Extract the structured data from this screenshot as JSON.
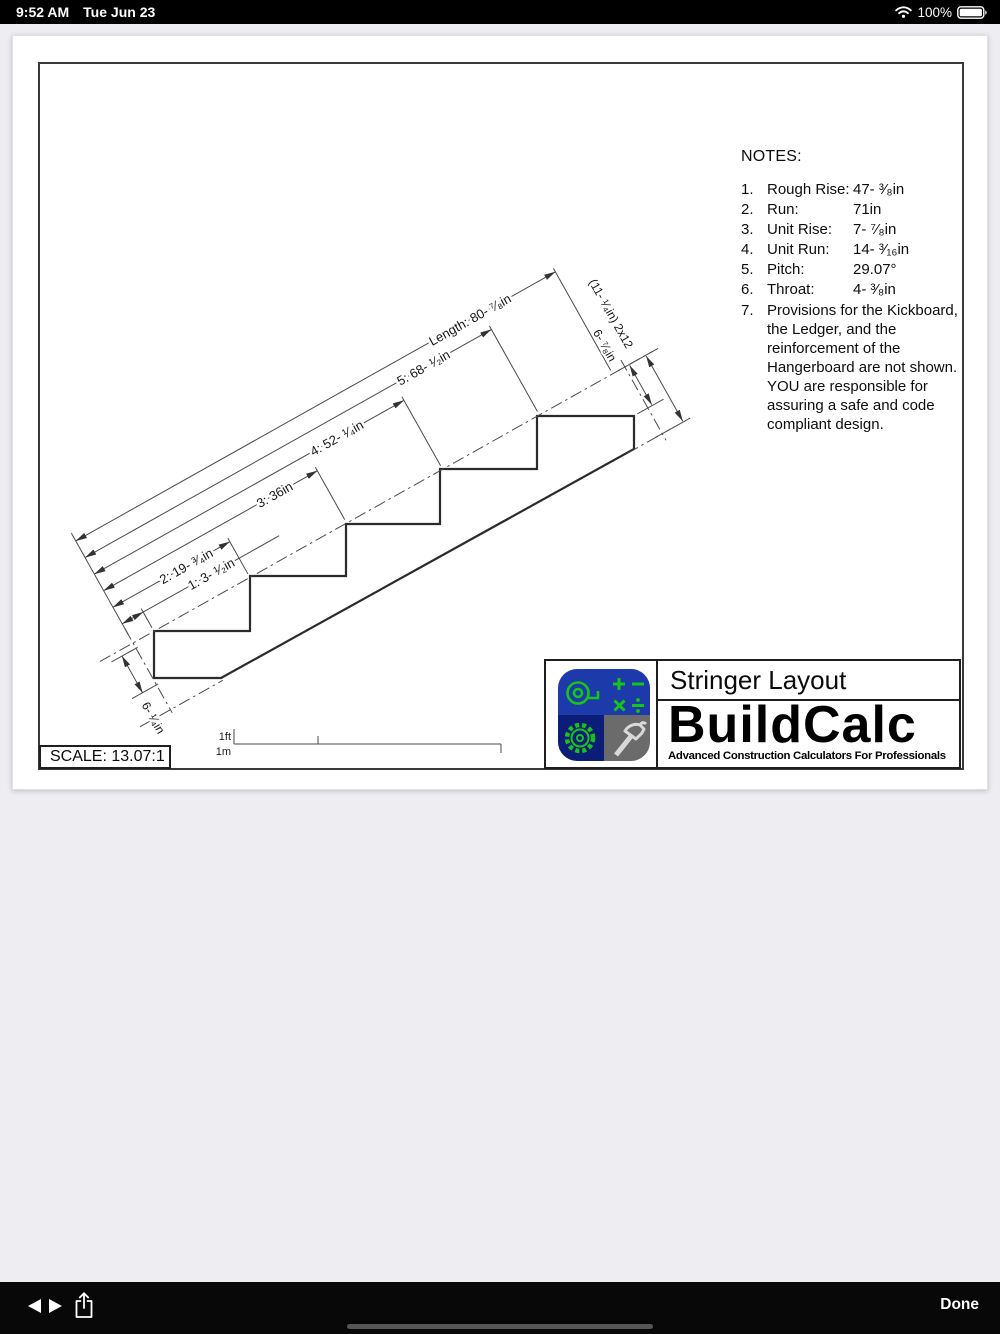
{
  "status": {
    "time": "9:52 AM",
    "date": "Tue Jun 23",
    "battery_pct": "100%"
  },
  "notes": {
    "title": "NOTES:",
    "items": [
      {
        "num": "1.",
        "label": "Rough Rise:",
        "value": "47- ³⁄₈in"
      },
      {
        "num": "2.",
        "label": "Run:",
        "value": "71in"
      },
      {
        "num": "3.",
        "label": "Unit Rise:",
        "value": "7- ⁷⁄₈in"
      },
      {
        "num": "4.",
        "label": "Unit Run:",
        "value": "14- ³⁄₁₆in"
      },
      {
        "num": "5.",
        "label": "Pitch:",
        "value": "29.07°"
      },
      {
        "num": "6.",
        "label": "Throat:",
        "value": "4- ³⁄₈in"
      }
    ],
    "item7": {
      "num": "7.",
      "text": "Provisions for the Kickboard, the Ledger, and the reinforcement of the Hangerboard are not shown. YOU are responsible for assuring a safe and code compliant design."
    }
  },
  "dims": {
    "d1": "1: 3- ¹⁄₂in",
    "d2": "2: 19- ³⁄₄in",
    "d3": "3: 36in",
    "d4": "4: 52- ¹⁄₄in",
    "d5": "5: 68- ¹⁄₂in",
    "length": "Length: 80- ⁷⁄₈in",
    "board": "(11- ¹⁄₄in) 2x12",
    "edge_depth": "6- ⁷⁄₈in",
    "bottom_depth": "6- ¹⁄₄in"
  },
  "scale": {
    "label": "SCALE: 13.07:1",
    "ft": "1ft",
    "m": "1m"
  },
  "title_block": {
    "title": "Stringer Layout",
    "brand": "BuildCalc",
    "tagline": "Advanced Construction Calculators For Professionals",
    "icon_colors": {
      "blue": "#1c3aa9",
      "navy": "#0c1d78",
      "gray": "#6b6b6b",
      "green": "#18c418"
    }
  },
  "toolbar": {
    "done": "Done"
  }
}
